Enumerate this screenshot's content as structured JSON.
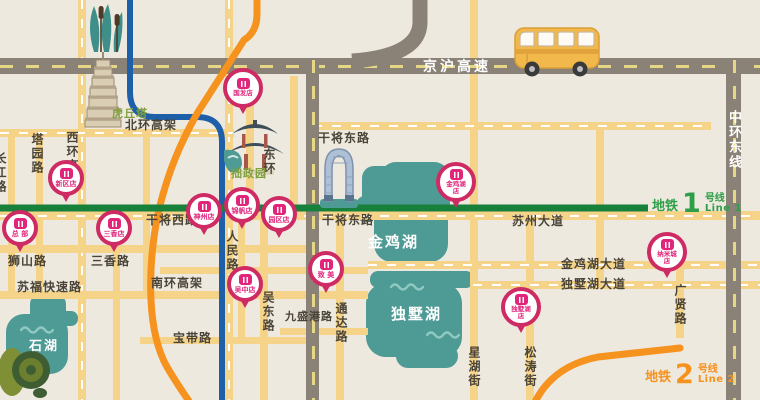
{
  "metro": {
    "line1": {
      "label_cn": "地铁",
      "number": "1",
      "label_suffix": "号线",
      "label_en": "Line 1",
      "text_color": "#2f9e48",
      "line_color": "#17803a"
    },
    "line2": {
      "label_cn": "地铁",
      "number": "2",
      "label_suffix": "号线",
      "label_en": "Line 2",
      "text_color": "#f6921e",
      "line_color": "#f6921e"
    },
    "blue_line_color": "#1e5fa9"
  },
  "highways": {
    "jinghu": "京沪高速",
    "zhonghuan_east": "中环东线"
  },
  "roads": {
    "beihuan_viaduct": "北环高架",
    "xihuan_viaduct": "西环高架",
    "tayuan": "塔园路",
    "changjiang": "长江路",
    "shishan": "狮山路",
    "sanxiang": "三香路",
    "sufu_express": "苏福快速路",
    "nanhuan_viaduct": "南环高架",
    "baodai": "宝带路",
    "ganjiang_west": "干将西路",
    "ganjiang_east_north": "干将东路",
    "ganjiang_east": "干将东路",
    "renmin": "人民路",
    "wudong": "吴东路",
    "jiushenggang": "九盛港路",
    "tongda": "通达路",
    "donghuan": "东环",
    "suzhou_avenue": "苏州大道",
    "jinjihu_avenue": "金鸡湖大道",
    "dushuhu_avenue": "独墅湖大道",
    "guangxian": "广贤路",
    "xinghu_street": "星湖街",
    "songtao_street": "松涛街"
  },
  "landmarks": {
    "huqiu_tower": "虎丘塔",
    "humble_garden": "拙政园"
  },
  "lakes": {
    "jinji": "金鸡湖",
    "dushu": "独墅湖",
    "shihu": "石湖"
  },
  "stores": [
    {
      "name": "国发店"
    },
    {
      "name": "新区店"
    },
    {
      "name": "总 部"
    },
    {
      "name": "三香店"
    },
    {
      "name": "神州店"
    },
    {
      "name": "锦帆店"
    },
    {
      "name": "园区店"
    },
    {
      "name": "吴中店"
    },
    {
      "name": "致 美"
    },
    {
      "name": "金鸡湖店"
    },
    {
      "name": "独墅湖店"
    },
    {
      "name": "纳米城店"
    }
  ],
  "icons": {
    "bus": "bus-icon",
    "pagoda": "huqiu-pagoda-icon",
    "pavilion": "garden-pavilion-icon",
    "gate_building": "gate-of-orient-icon",
    "reeds": "reeds-icon",
    "plant": "plant-icon",
    "store_pin": "store-pin-icon"
  },
  "colors": {
    "background": "#eee9df",
    "road_yellow": "#f5d489",
    "highway_gray": "#8a8177",
    "lake_teal": "#4e9a94",
    "pin_ring": "#ce2a63",
    "pin_text": "#e0257b"
  }
}
